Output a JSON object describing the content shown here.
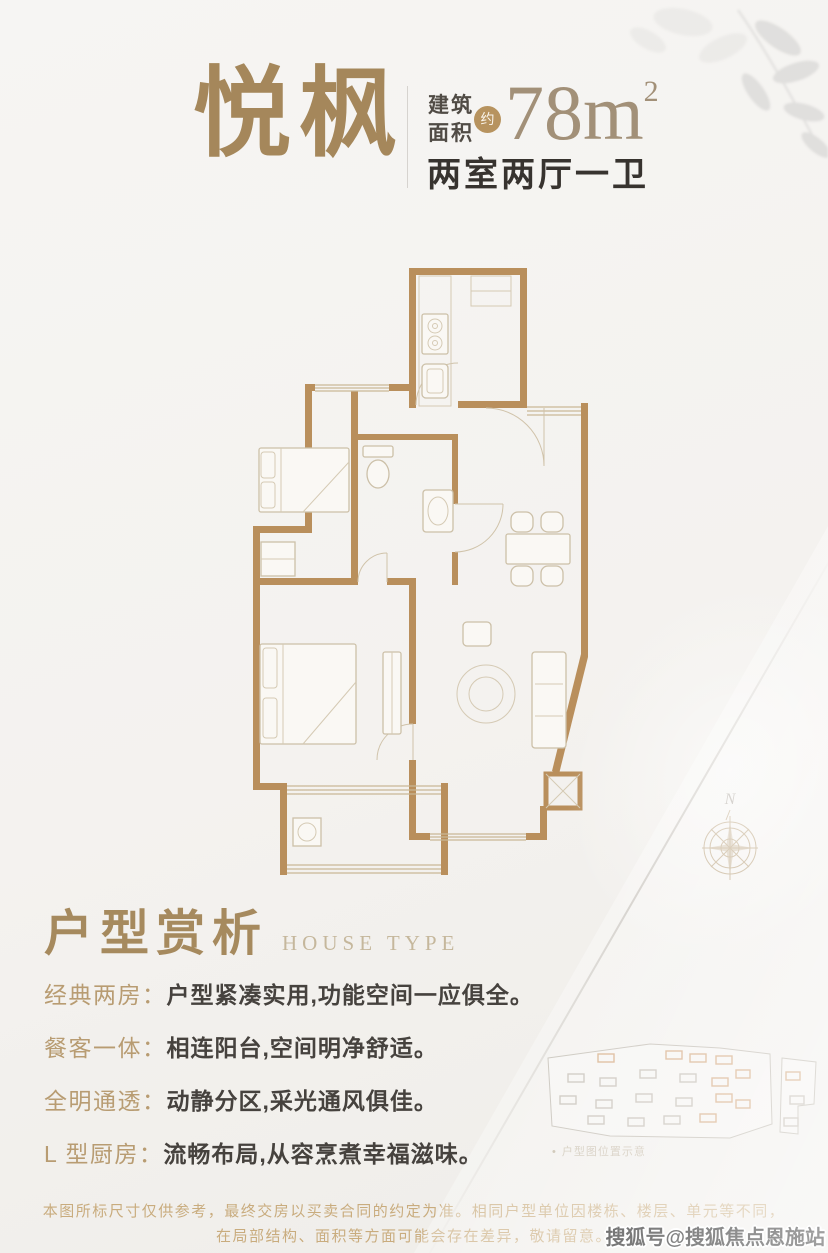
{
  "colors": {
    "background": "#f5f4f2",
    "accent_tan": "#a98c5e",
    "wall_tan": "#b98f5c",
    "title_bronze": "#a5875b",
    "dark_text": "#37332f",
    "feature_label": "#b89c72",
    "feature_text": "#46423e",
    "disclaimer": "#c9ac7e"
  },
  "header": {
    "title": "悦枫",
    "area_label_1": "建筑",
    "area_label_2": "面积",
    "approx": "约",
    "area_value": "78m",
    "area_sup": "2",
    "layout_text": "两室两厅一卫"
  },
  "floor_plan": {
    "compass_label": "N"
  },
  "section": {
    "title_cn": "户型赏析",
    "title_en": "HOUSE TYPE"
  },
  "features": [
    {
      "label": "经典两房：",
      "text": "户型紧凑实用,功能空间一应俱全。"
    },
    {
      "label": "餐客一体：",
      "text": "相连阳台,空间明净舒适。"
    },
    {
      "label": "全明通透：",
      "text": "动静分区,采光通风俱佳。"
    },
    {
      "label": "L 型厨房：",
      "text": "流畅布局,从容烹煮幸福滋味。"
    }
  ],
  "site_plan": {
    "bullet": "•",
    "caption": "户型图位置示意"
  },
  "disclaimer": {
    "line1": "本图所标尺寸仅供参考，最终交房以买卖合同的约定为准。相同户型单位因楼栋、楼层、单元等不同，",
    "line2": "在局部结构、面积等方面可能会存在差异，敬请留意。"
  },
  "watermark": "搜狐号@搜狐焦点恩施站"
}
